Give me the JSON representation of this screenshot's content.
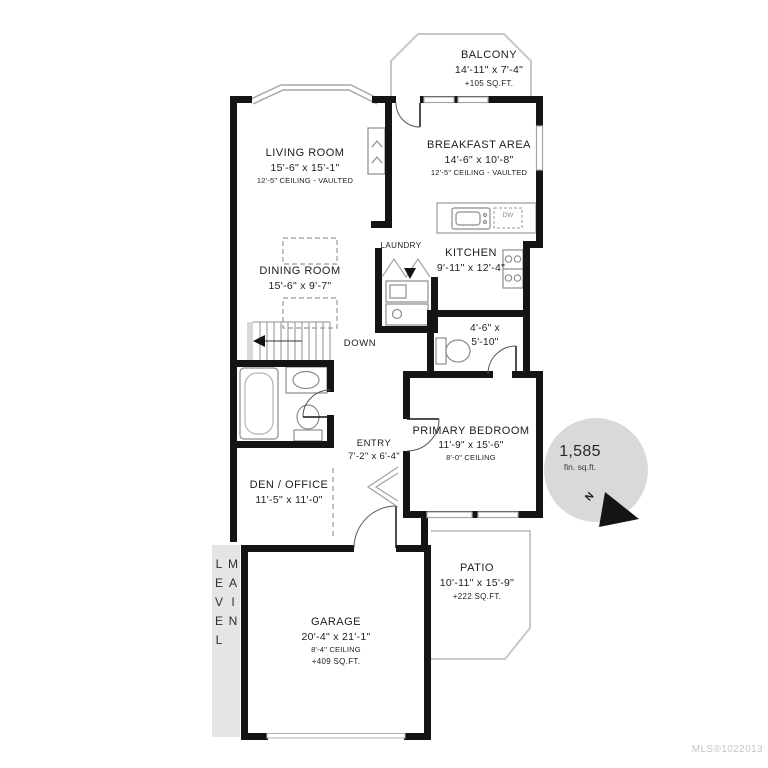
{
  "level_label": "MAIN LEVEL",
  "watermark": "MLS®1022013",
  "badge": {
    "area": "1,585",
    "unit": "fin. sq.ft."
  },
  "compass": {
    "label": "N"
  },
  "appliances": {
    "dishwasher": "DW"
  },
  "rooms": {
    "balcony": {
      "name": "BALCONY",
      "dims": "14'-11\" x 7'-4\"",
      "area": "+105 SQ.FT."
    },
    "living_room": {
      "name": "LIVING ROOM",
      "dims": "15'-6\" x 15'-1\"",
      "note": "12'-5\" CEILING - VAULTED"
    },
    "breakfast_area": {
      "name": "BREAKFAST AREA",
      "dims": "14'-6\" x 10'-8\"",
      "note": "12'-5\" CEILING - VAULTED"
    },
    "laundry": {
      "name": "LAUNDRY"
    },
    "kitchen": {
      "name": "KITCHEN",
      "dims": "9'-11\" x 12'-4\""
    },
    "dining_room": {
      "name": "DINING ROOM",
      "dims": "15'-6\" x 9'-7\""
    },
    "stairs": {
      "label": "DOWN"
    },
    "bathroom": {
      "dims_line1": "4'-6\" x",
      "dims_line2": "5'-10\""
    },
    "primary_bedroom": {
      "name": "PRIMARY BEDROOM",
      "dims": "11'-9\" x 15'-6\"",
      "note": "8'-0\" CEILING"
    },
    "entry": {
      "name": "ENTRY",
      "dims": "7'-2\" x 6'-4\""
    },
    "den_office": {
      "name": "DEN / OFFICE",
      "dims": "11'-5\" x 11'-0\""
    },
    "garage": {
      "name": "GARAGE",
      "dims": "20'-4\" x 21'-1\"",
      "note": "8'-4\" CEILING",
      "area": "+409 SQ.FT."
    },
    "patio": {
      "name": "PATIO",
      "dims": "10'-11\" x 15'-9\"",
      "area": "+222 SQ.FT."
    }
  },
  "colors": {
    "wall": "#141414",
    "fixture": "#8c8c8c",
    "outline": "#c7c7c7",
    "band_bg": "#e5e5e5",
    "badge_bg": "#d9d9d9",
    "watermark": "#c6c6c6"
  }
}
